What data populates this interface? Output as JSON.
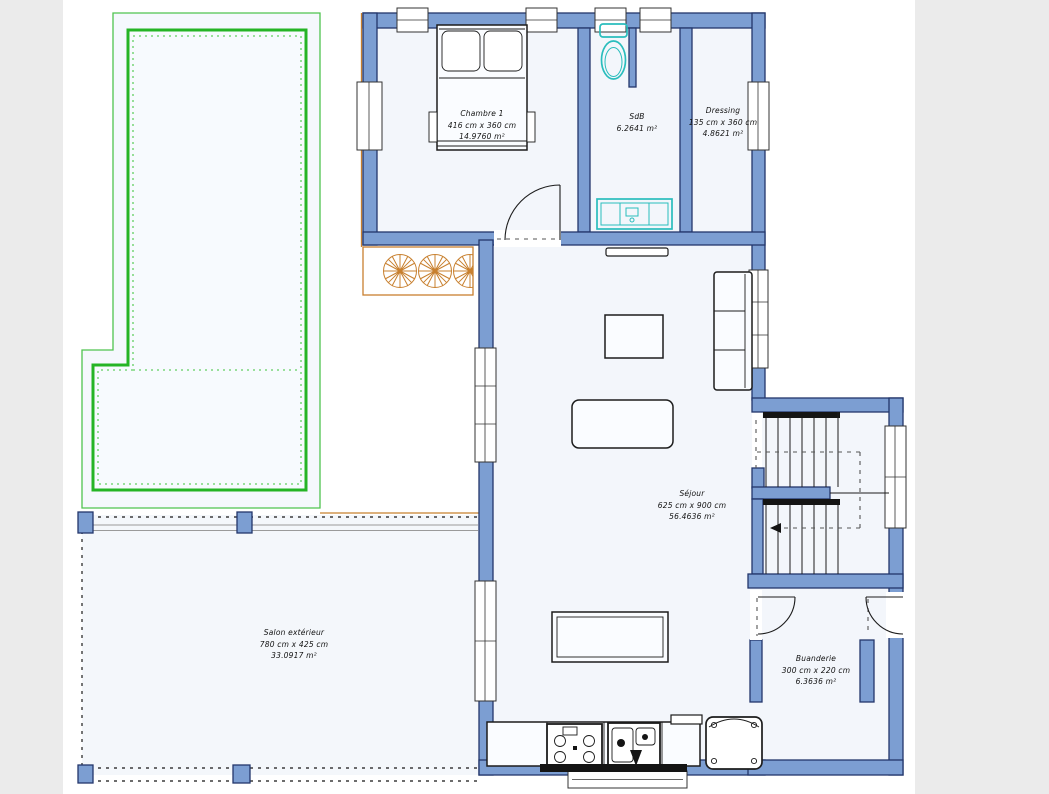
{
  "canvas": {
    "width": 1049,
    "height": 794,
    "background": "#ffffff",
    "gutter_color": "#ebebeb"
  },
  "palette": {
    "wall_fill": "#7c9ed2",
    "wall_stroke": "#23366b",
    "room_fill": "#f3f6fb",
    "pool_green": "#25b425",
    "pool_outline_green": "#4fc34f",
    "deck_orange": "#c8802f",
    "sanitary_teal": "#2abdbd",
    "furniture_line": "#1c1c1c"
  },
  "rooms": [
    {
      "name": "Chambre 1",
      "dimensions": "416 cm x 360 cm",
      "area": "14.9760 m²"
    },
    {
      "name": "SdB",
      "dimensions": "",
      "area": "6.2641 m²"
    },
    {
      "name": "Dressing",
      "dimensions": "135 cm x 360 cm",
      "area": "4.8621 m²"
    },
    {
      "name": "Séjour",
      "dimensions": "625 cm x 900 cm",
      "area": "56.4636 m²"
    },
    {
      "name": "Salon extérieur",
      "dimensions": "780 cm x 425 cm",
      "area": "33.0917 m²"
    },
    {
      "name": "Buanderie",
      "dimensions": "300 cm x 220 cm",
      "area": "6.3636 m²"
    }
  ]
}
